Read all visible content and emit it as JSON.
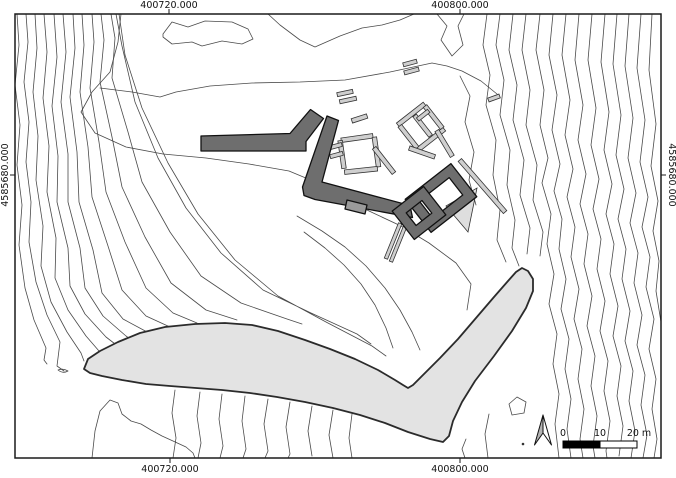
{
  "map": {
    "type": "topographic archaeological site plan",
    "axis_labels": {
      "top_left": "400720.000",
      "top_right": "400800.000",
      "bottom_left": "400720.000",
      "bottom_right": "400800.000",
      "left": "4585680.000",
      "right": "4585680.000"
    },
    "scale_bar": {
      "label_0": "0",
      "label_10": "10",
      "label_20": "20 m"
    },
    "legend_semantics": {
      "dark_walls": "excavated structures",
      "light_walls": "wall remains",
      "shaded_area": "excavation / trench area",
      "thin_lines": "elevation contour lines",
      "north_arrow": "north arrow"
    },
    "colors": {
      "contour": "#4a4a4a",
      "wall_dark": "#6e6e6e",
      "wall_light": "#cfcfcf",
      "area_fill": "#e3e3e3",
      "frame": "#1a1a1a"
    }
  }
}
